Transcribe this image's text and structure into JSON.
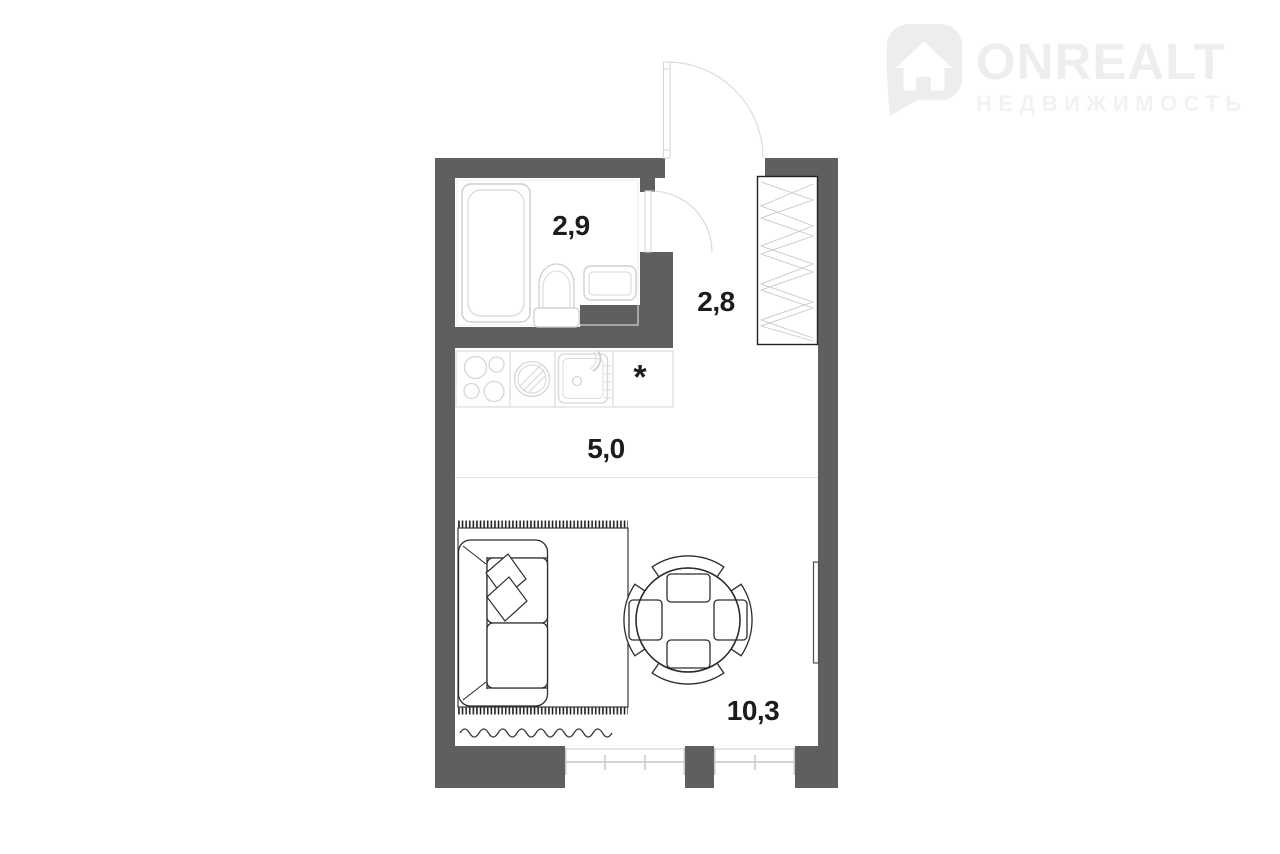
{
  "watermark": {
    "brand": "ONREALT",
    "tagline": "НЕДВИЖИМОСТЬ"
  },
  "floor_plan": {
    "rooms": [
      {
        "name": "bathroom",
        "area_label": "2,9"
      },
      {
        "name": "hallway",
        "area_label": "2,8"
      },
      {
        "name": "kitchen-zone",
        "area_label": "5,0"
      },
      {
        "name": "living-room",
        "area_label": "10,3"
      }
    ],
    "kitchen_note": "*",
    "furniture": [
      "bathtub",
      "toilet",
      "bathroom-sink",
      "wardrobe",
      "entrance-door",
      "bathroom-door",
      "stove",
      "washing-machine",
      "kitchen-sink",
      "counter",
      "rug",
      "sofa",
      "dining-table",
      "chairs",
      "radiator",
      "windows"
    ]
  },
  "colors": {
    "wall": "#5f5f5f",
    "dark_line": "#2e2e2e",
    "light_line": "#d6d6d6",
    "watermark": "#eeeeee",
    "background": "#ffffff"
  }
}
